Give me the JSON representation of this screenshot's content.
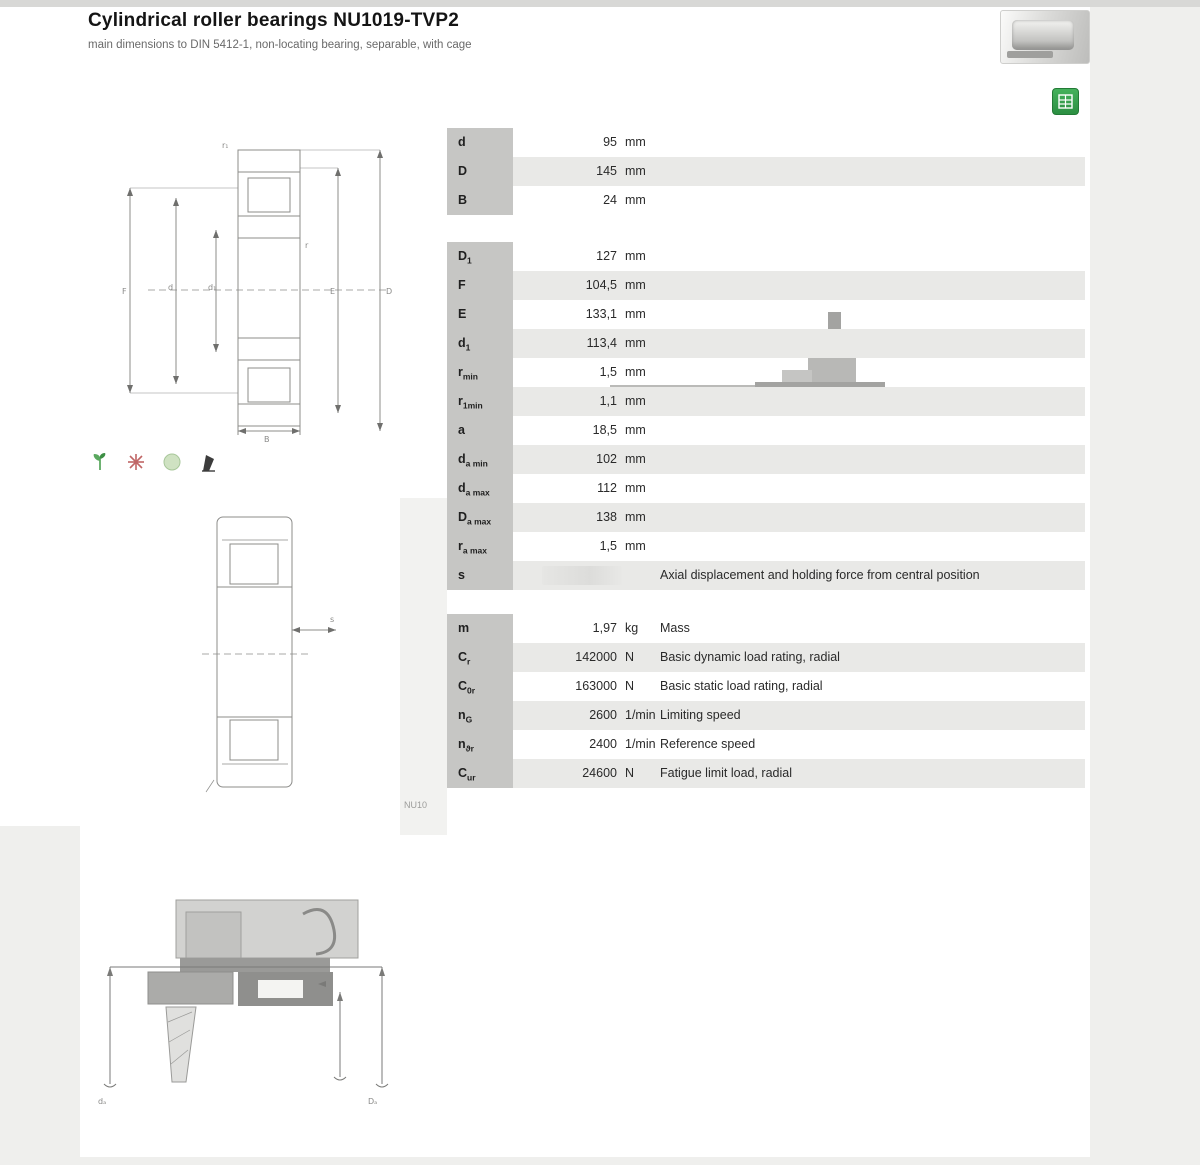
{
  "header": {
    "title": "Cylindrical roller bearings NU1019-TVP2",
    "subtitle": "main dimensions to DIN 5412-1, non-locating bearing, separable, with cage"
  },
  "colors": {
    "accent_green": "#2f9e44",
    "row_stripe": "#e9e9e7",
    "symbol_cell": "#c6c6c4"
  },
  "icons": {
    "product_photo": "bearing-photo",
    "action": "calculate-grid-icon",
    "features": [
      "green-leaf-icon",
      "red-burst-icon",
      "pale-green-dot-icon",
      "black-flag-icon"
    ]
  },
  "drawing1": {
    "labels": {
      "F": "F",
      "d": "d",
      "d1": "d₁",
      "E": "E",
      "D": "D",
      "B": "B",
      "r": "r",
      "r1": "r₁"
    }
  },
  "drawing2": {
    "labels": {
      "s": "s"
    }
  },
  "drawing3": {
    "labels": {
      "da": "dₐ",
      "Da": "Dₐ"
    },
    "caption": "NU10"
  },
  "table_main": {
    "rows": [
      {
        "symbol": "d",
        "sub": "",
        "value": "95",
        "unit": "mm"
      },
      {
        "symbol": "D",
        "sub": "",
        "value": "145",
        "unit": "mm"
      },
      {
        "symbol": "B",
        "sub": "",
        "value": "24",
        "unit": "mm"
      }
    ]
  },
  "table_dims": {
    "rows": [
      {
        "symbol": "D",
        "sub": "1",
        "value": "127",
        "unit": "mm"
      },
      {
        "symbol": "F",
        "sub": "",
        "value": "104,5",
        "unit": "mm"
      },
      {
        "symbol": "E",
        "sub": "",
        "value": "133,1",
        "unit": "mm"
      },
      {
        "symbol": "d",
        "sub": "1",
        "value": "113,4",
        "unit": "mm"
      },
      {
        "symbol": "r",
        "sub": "min",
        "value": "1,5",
        "unit": "mm"
      },
      {
        "symbol": "r",
        "sub": "1min",
        "value": "1,1",
        "unit": "mm"
      },
      {
        "symbol": "a",
        "sub": "",
        "value": "18,5",
        "unit": "mm"
      },
      {
        "symbol": "d",
        "sub": "a min",
        "value": "102",
        "unit": "mm"
      },
      {
        "symbol": "d",
        "sub": "a max",
        "value": "112",
        "unit": "mm"
      },
      {
        "symbol": "D",
        "sub": "a max",
        "value": "138",
        "unit": "mm"
      },
      {
        "symbol": "r",
        "sub": "a max",
        "value": "1,5",
        "unit": "mm"
      },
      {
        "symbol": "s",
        "sub": "",
        "value": "",
        "unit": "",
        "desc": "Axial displacement and holding force from central position"
      }
    ]
  },
  "table_perf": {
    "rows": [
      {
        "symbol": "m",
        "sub": "",
        "value": "1,97",
        "unit": "kg",
        "desc": "Mass"
      },
      {
        "symbol": "C",
        "sub": "r",
        "value": "142000",
        "unit": "N",
        "desc": "Basic dynamic load rating, radial"
      },
      {
        "symbol": "C",
        "sub": "0r",
        "value": "163000",
        "unit": "N",
        "desc": "Basic static load rating, radial"
      },
      {
        "symbol": "n",
        "sub": "G",
        "value": "2600",
        "unit": "1/min",
        "desc": "Limiting speed"
      },
      {
        "symbol": "n",
        "sub": "ϑr",
        "value": "2400",
        "unit": "1/min",
        "desc": "Reference speed"
      },
      {
        "symbol": "C",
        "sub": "ur",
        "value": "24600",
        "unit": "N",
        "desc": "Fatigue limit load, radial"
      }
    ]
  }
}
